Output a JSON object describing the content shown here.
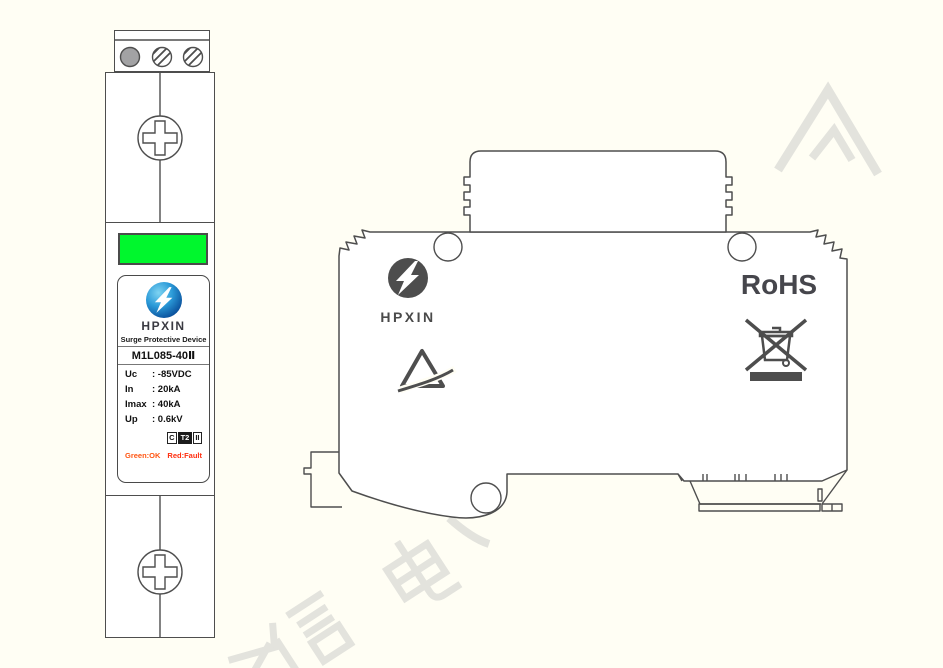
{
  "colors": {
    "background": "#fffef4",
    "outline": "#4e4e4e",
    "indicator_green": "#00f72d",
    "side_mark_gray": "#4d4d4d",
    "watermark_gray": "#e3e3dd",
    "logo_blue_dark": "#073c7c",
    "logo_blue_light": "#7fd4f2",
    "status_ok_color": "#ff5512",
    "status_fault_color": "#ff2d0e"
  },
  "front_view": {
    "label": {
      "brand": "HPXIN",
      "device_type": "Surge Protective Device",
      "model": "M1L085-40Ⅱ",
      "specs": [
        {
          "param": "Uc",
          "value": ": -85VDC"
        },
        {
          "param": "In",
          "value": ": 20kA"
        },
        {
          "param": "Imax",
          "value": ": 40kA"
        },
        {
          "param": "Up",
          "value": ": 0.6kV"
        }
      ],
      "class_marks": {
        "box1": "C",
        "box2": "T2",
        "box3": "II"
      },
      "status_legend": {
        "ok": "Green:OK",
        "fault": "Red:Fault"
      }
    }
  },
  "side_view": {
    "brand": "HPXIN",
    "rohs": "RoHS"
  },
  "watermark": {
    "visible_characters": "信 电"
  }
}
